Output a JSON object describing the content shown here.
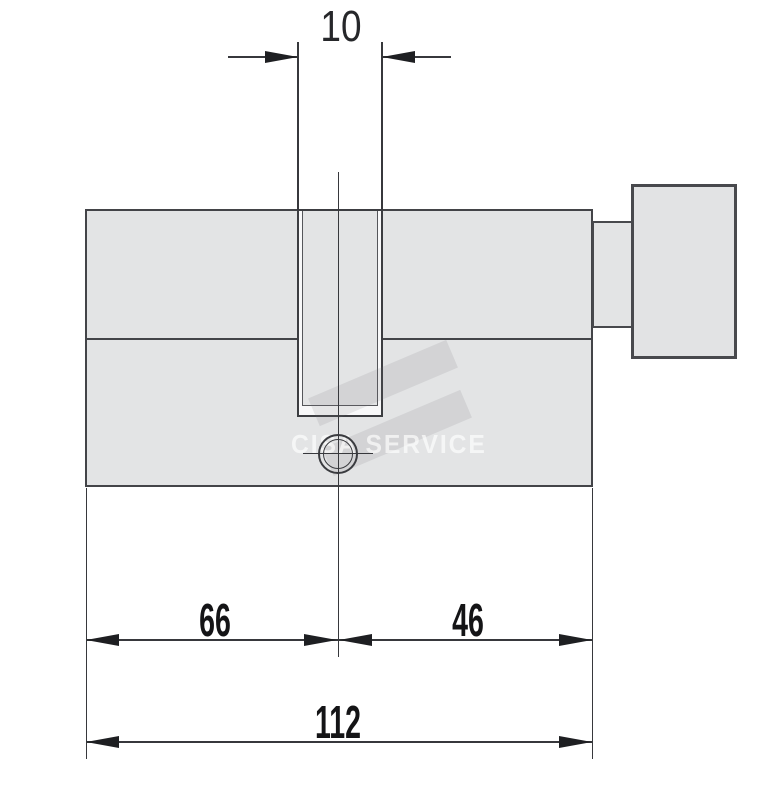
{
  "diagram": {
    "kind": "technical dimension drawing",
    "subject": "euro profile lock cylinder with thumbturn knob"
  },
  "watermark": {
    "brand_text": "CISA SERVICE"
  },
  "dimensions": {
    "slot_width_label": "10",
    "left_side_label": "66",
    "right_side_label": "46",
    "overall_length_label": "112"
  },
  "colors": {
    "background": "#ffffff",
    "body_fill": "#e3e4e5",
    "outline": "#434448",
    "thin_line": "#37383c",
    "arrow_and_text": "#1e1f22",
    "slot_highlight": "#f8f8f9",
    "watermark_text": "rgba(255,255,255,0.65)",
    "watermark_band": "rgba(110,112,118,0.14)"
  }
}
